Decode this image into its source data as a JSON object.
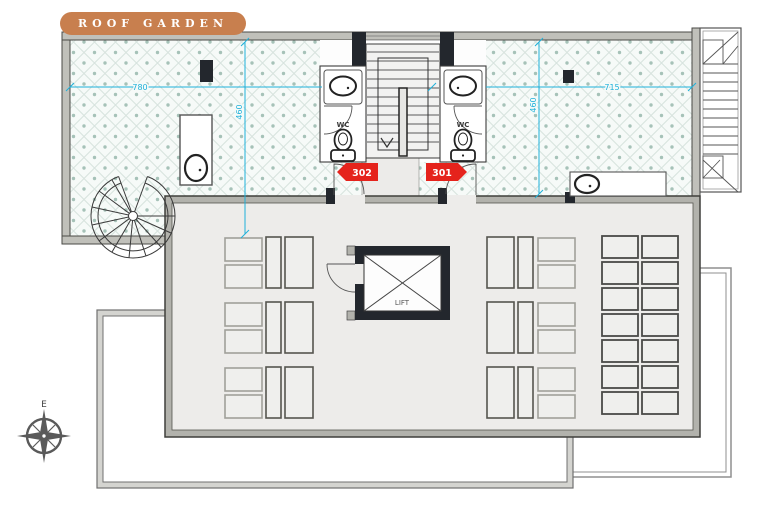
{
  "labels": {
    "roof_garden": "ROOF GARDEN",
    "lift": "LIFT",
    "wc_left": "WC",
    "wc_right": "WC",
    "compass": "E"
  },
  "units": {
    "left_badge": "302",
    "right_badge": "301"
  },
  "dimensions": {
    "horizontal_left": "780",
    "horizontal_right": "715",
    "vertical_left": "460",
    "vertical_right": "460",
    "color": "#1fb1da"
  },
  "colors": {
    "pill_bg": "#c87f4e",
    "pill_text": "#ffffff",
    "unit_badge": "#e5231c",
    "dimension": "#1fb1da",
    "tile_dot": "#a6c2b8",
    "tile_line": "#d7e3de",
    "wall_dark": "#23272d",
    "wall_gray": "#b2b2ac",
    "floor_gray": "#edecea"
  }
}
